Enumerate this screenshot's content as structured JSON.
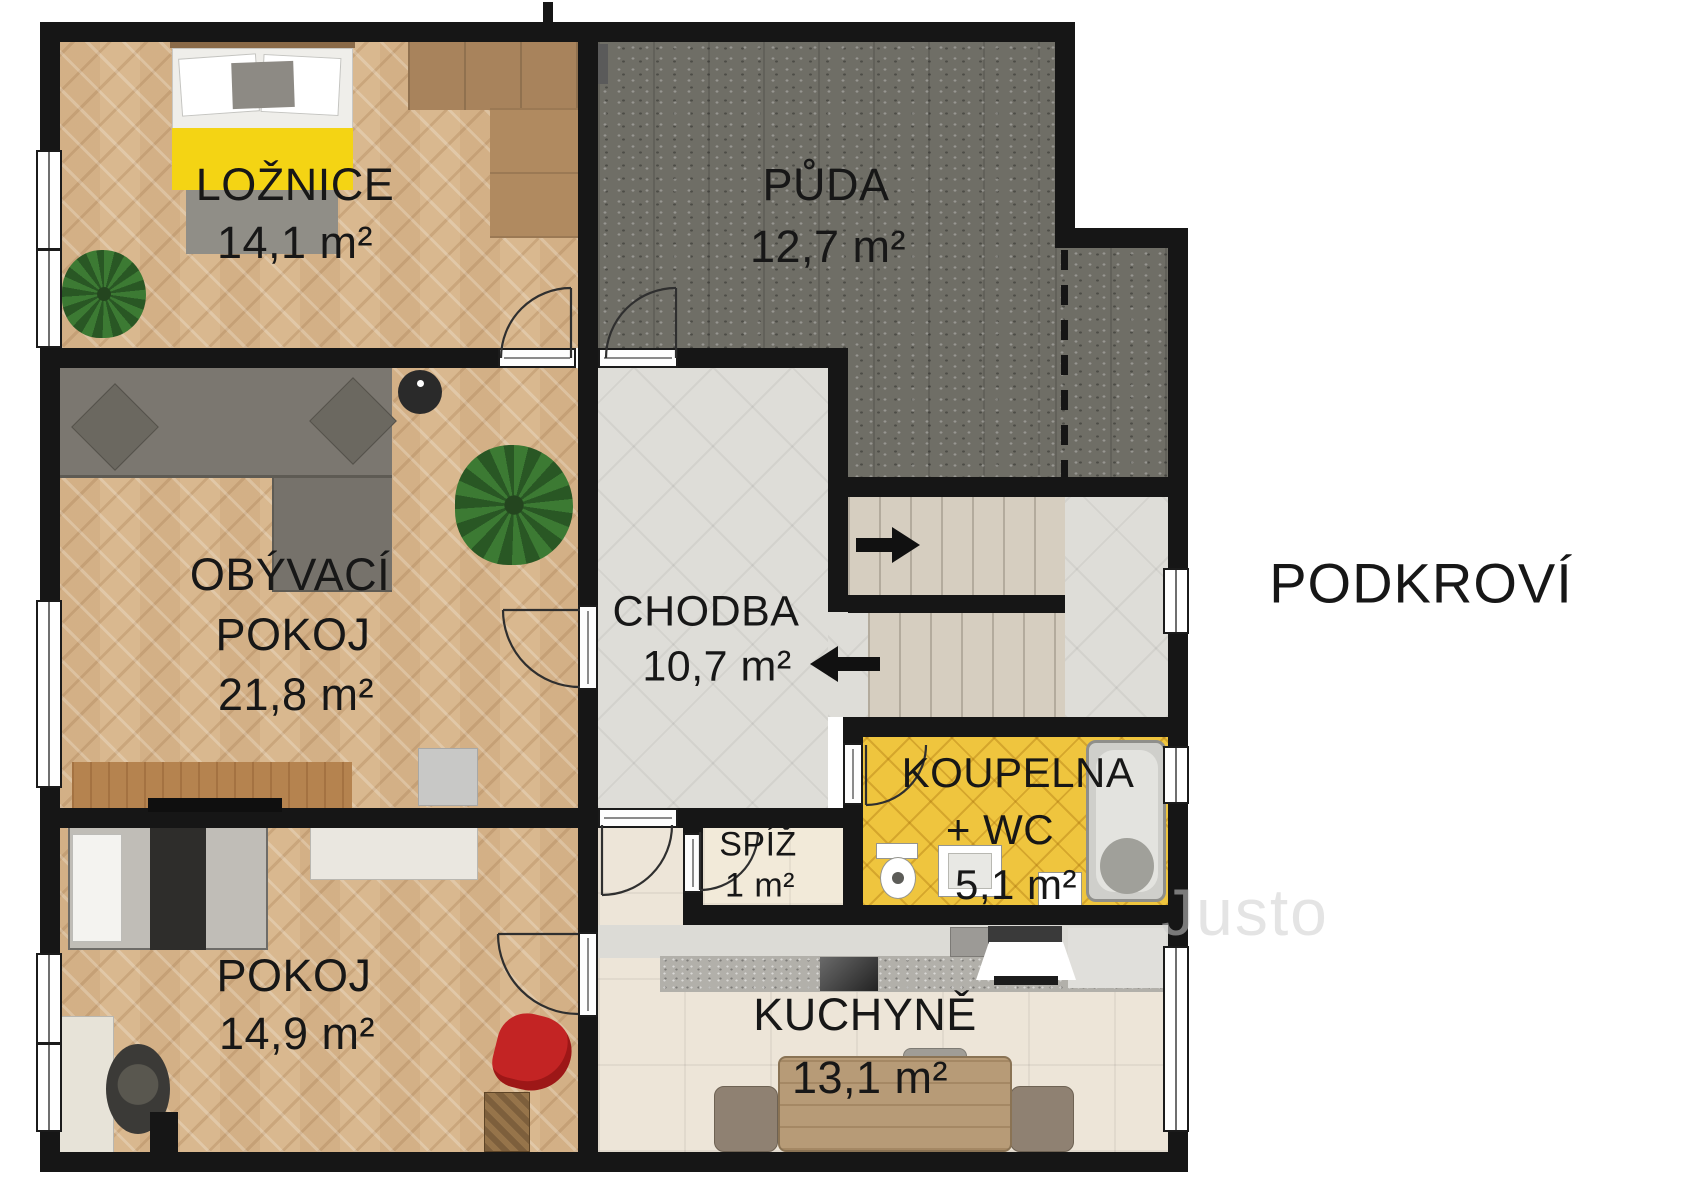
{
  "floor_plan": {
    "title": "PODKROVÍ",
    "watermark": "Justo",
    "rooms": {
      "loznice": {
        "name": "LOŽNICE",
        "area": "14,1 m²"
      },
      "puda": {
        "name": "PŮDA",
        "area": "12,7 m²"
      },
      "obyvaci_pokoj": {
        "name_line1": "OBÝVACÍ",
        "name_line2": "POKOJ",
        "area": "21,8 m²"
      },
      "chodba": {
        "name": "CHODBA",
        "area": "10,7 m²"
      },
      "koupelna": {
        "name_line1": "KOUPELNA",
        "name_line2": "+ WC",
        "area": "5,1 m²"
      },
      "spiz": {
        "name": "SPÍŽ",
        "area": "1 m²"
      },
      "kuchyne": {
        "name": "KUCHYNĚ",
        "area": "13,1 m²"
      },
      "pokoj": {
        "name": "POKOJ",
        "area": "14,9 m²"
      }
    },
    "colors": {
      "wall": "#161616",
      "parquet_floor": "#d9b88f",
      "attic_floor": "#6f6e66",
      "tile_floor": "#deddd8",
      "kitchen_floor": "#ede5d8",
      "bathroom_tile": "#efc53e",
      "blanket_accent": "#f4d414",
      "beanbag_red": "#c32424"
    }
  }
}
